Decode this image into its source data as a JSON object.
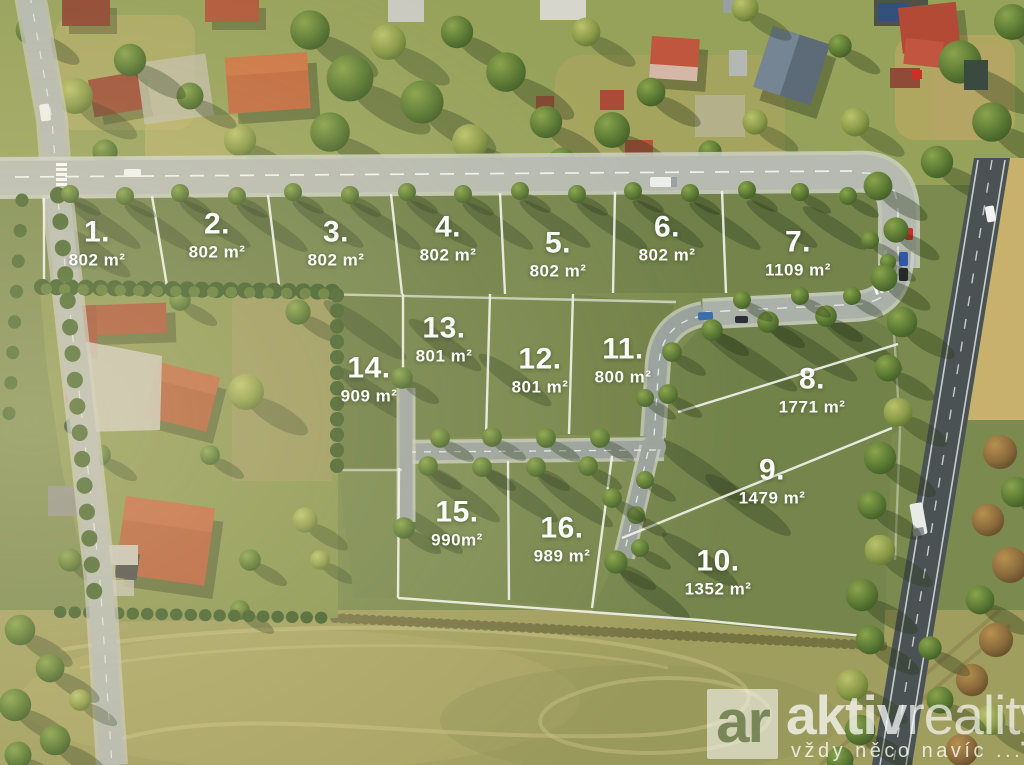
{
  "plots": [
    {
      "id": 1,
      "number": "1.",
      "area": "802 m²"
    },
    {
      "id": 2,
      "number": "2.",
      "area": "802 m²"
    },
    {
      "id": 3,
      "number": "3.",
      "area": "802 m²"
    },
    {
      "id": 4,
      "number": "4.",
      "area": "802 m²"
    },
    {
      "id": 5,
      "number": "5.",
      "area": "802 m²"
    },
    {
      "id": 6,
      "number": "6.",
      "area": "802 m²"
    },
    {
      "id": 7,
      "number": "7.",
      "area": "1109 m²"
    },
    {
      "id": 8,
      "number": "8.",
      "area": "1771 m²"
    },
    {
      "id": 9,
      "number": "9.",
      "area": "1479 m²"
    },
    {
      "id": 10,
      "number": "10.",
      "area": "1352 m²"
    },
    {
      "id": 11,
      "number": "11.",
      "area": "800 m²"
    },
    {
      "id": 12,
      "number": "12.",
      "area": "801 m²"
    },
    {
      "id": 13,
      "number": "13.",
      "area": "801 m²"
    },
    {
      "id": 14,
      "number": "14.",
      "area": "909 m²"
    },
    {
      "id": 15,
      "number": "15.",
      "area": "990m²"
    },
    {
      "id": 16,
      "number": "16.",
      "area": "989 m²"
    }
  ],
  "watermark": {
    "logo_text": "ar",
    "brand_bold": "aktiv",
    "brand_light": "reality",
    "tagline": "vždy něco navíc ..."
  },
  "colors": {
    "plot_green": "#75854a",
    "boundary_white": "#f2f2ec",
    "road_gray": "#b6bab0",
    "highway_dark": "#4b5254",
    "label_text": "#ffffff"
  }
}
